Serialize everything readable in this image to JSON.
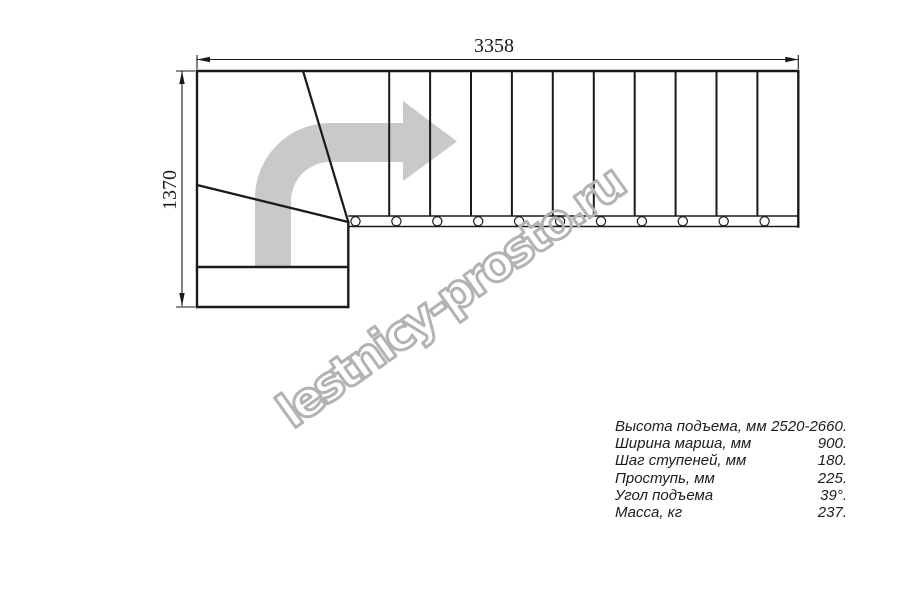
{
  "drawing": {
    "watermark": "lestnicy-prosto.ru",
    "dimensions": {
      "width_label": "3358",
      "height_label": "1370"
    },
    "colors": {
      "line": "#1a1a1a",
      "arrow": "#c9c9c9",
      "watermark_stroke": "#b3b3b3"
    }
  },
  "specs": {
    "rows": [
      {
        "label": "Высота подъема, мм",
        "value": "2520-2660."
      },
      {
        "label": "Ширина марша, мм",
        "value": "900."
      },
      {
        "label": "Шаг ступеней, мм",
        "value": "180."
      },
      {
        "label": "Проступь, мм",
        "value": "225."
      },
      {
        "label": "Угол подъема",
        "value": "39°."
      },
      {
        "label": "Масса, кг",
        "value": "237."
      }
    ]
  }
}
